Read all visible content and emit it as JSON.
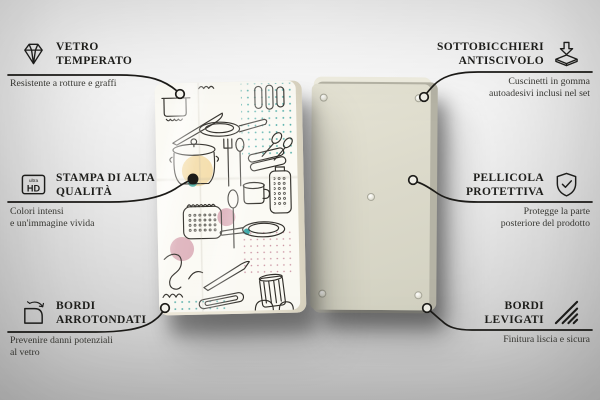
{
  "callouts": [
    {
      "id": "vetro-temperato",
      "side": "left",
      "icon": "diamond-icon",
      "title": [
        "VETRO",
        "TEMPERATO"
      ],
      "subtitle": [
        "Resistente a rotture e graffi"
      ]
    },
    {
      "id": "stampa-di-alta-qualita",
      "side": "left",
      "icon": "ultra-hd-icon",
      "icon_text": {
        "small": "ultra",
        "big": "HD"
      },
      "title": [
        "STAMPA DI ALTA",
        "QUALITÀ"
      ],
      "subtitle": [
        "Colori intensi",
        "e un'immagine vivida"
      ]
    },
    {
      "id": "bordi-arrotondati",
      "side": "left",
      "icon": "rounded-corner-icon",
      "title": [
        "BORDI",
        "ARROTONDATI"
      ],
      "subtitle": [
        "Prevenire danni potenziali",
        "al vetro"
      ]
    },
    {
      "id": "sottobicchieri-antiscivolo",
      "side": "right",
      "icon": "non-slip-pad-icon",
      "title": [
        "SOTTOBICCHIERI",
        "ANTISCIVOLO"
      ],
      "subtitle": [
        "Cuscinetti in gomma",
        "autoadesivi inclusi nel set"
      ]
    },
    {
      "id": "pellicola-protettiva",
      "side": "right",
      "icon": "shield-check-icon",
      "title": [
        "PELLICOLA",
        "PROTETTIVA"
      ],
      "subtitle": [
        "Protegge la parte",
        "posteriore del prodotto"
      ]
    },
    {
      "id": "bordi-levigati",
      "side": "right",
      "icon": "smooth-edges-icon",
      "title": [
        "BORDI",
        "LEVIGATI"
      ],
      "subtitle": [
        "Finitura liscia e sicura"
      ]
    }
  ],
  "product": {
    "front_panel": "pannello in vetro con motivo utensili da cucina",
    "back_panel": "retro con sottobicchieri antiscivolo",
    "pad_count": 5
  },
  "colors": {
    "line": "#1c1b18",
    "text": "#1f1f1c",
    "subtext": "#3a3a35",
    "accent_teal": "#46a9a4",
    "accent_peach": "#f5dfae",
    "accent_pink": "#d9a8b4",
    "front_panel": "#fbfaf4",
    "back_panel": "#dcdacb"
  }
}
